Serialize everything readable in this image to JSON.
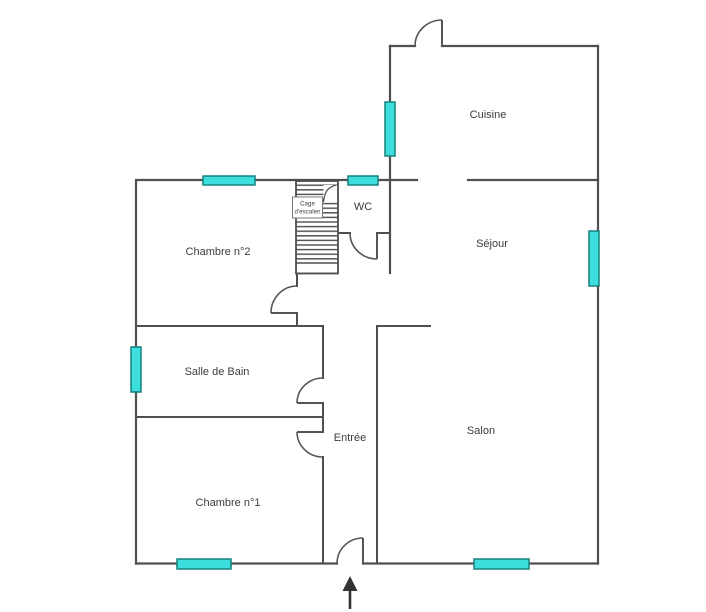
{
  "plan": {
    "type": "floor-plan",
    "language": "fr"
  },
  "rooms": {
    "cuisine": "Cuisine",
    "sejour": "Séjour",
    "wc": "WC",
    "chambre2": "Chambre n°2",
    "salle_de_bain": "Salle de Bain",
    "entree": "Entrée",
    "salon": "Salon",
    "chambre1": "Chambre n°1"
  },
  "stairwell": {
    "label_line1": "Cage",
    "label_line2": "d'escalier"
  },
  "colors": {
    "background": "#ffffff",
    "wall": "#4f4f4f",
    "door": "#555555",
    "window_fill": "#3edede",
    "window_stroke": "#17807d",
    "label": "#3d3d3d",
    "arrow": "#333333"
  }
}
